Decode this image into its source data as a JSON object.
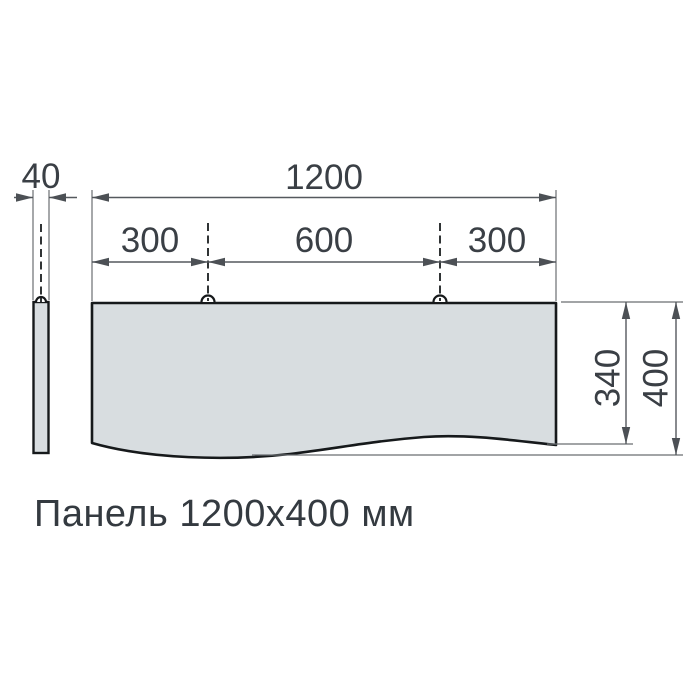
{
  "drawing": {
    "caption": "Панель 1200x400 мм",
    "top_view": {
      "total_width_label": "1200",
      "left_hanger_offset_label": "300",
      "hanger_spacing_label": "600",
      "right_hanger_offset_label": "300",
      "front_edge_height_label": "340",
      "total_height_label": "400"
    },
    "side_view": {
      "thickness_label": "40"
    },
    "colors": {
      "panel_fill": "#d8dde0",
      "outline": "#16191b",
      "dimension_line": "#55595e",
      "text": "#3a3f45",
      "background": "#ffffff"
    }
  }
}
